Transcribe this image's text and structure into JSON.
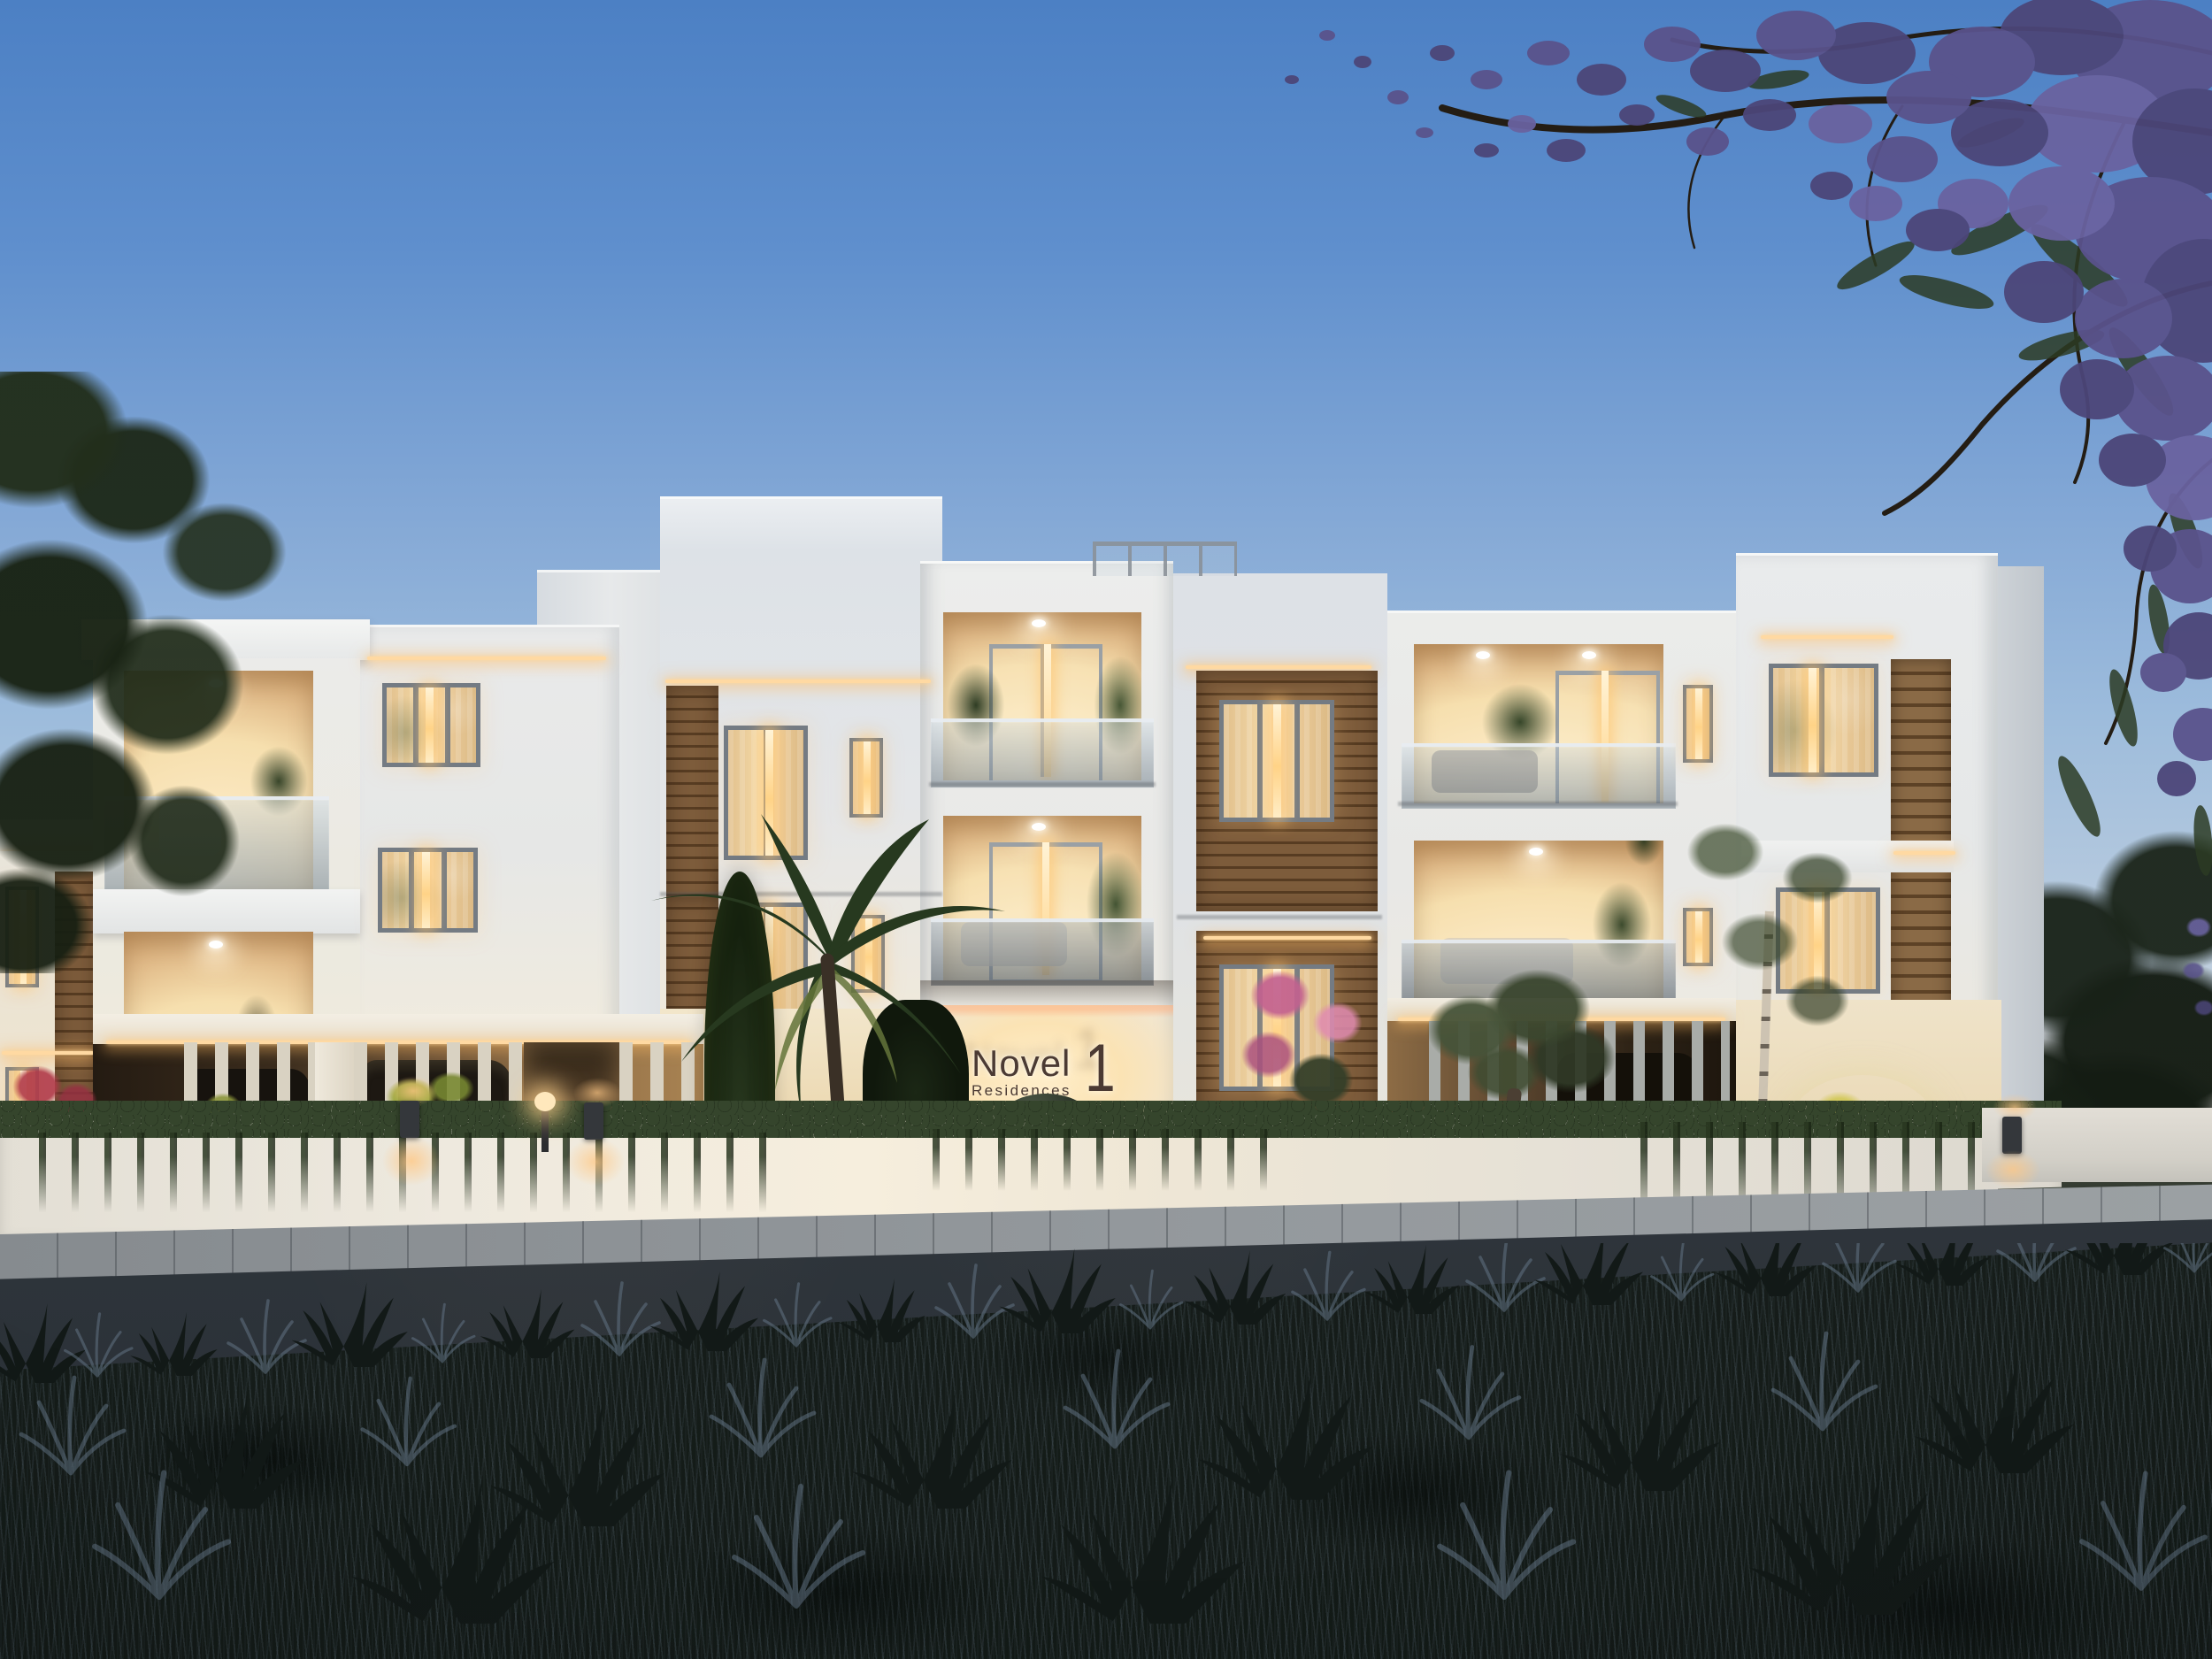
{
  "sign": {
    "brand": "Novel",
    "subtitle": "Residences",
    "number": "1"
  },
  "colors": {
    "sky_top": "#4c80c4",
    "sky_mid": "#85a9d6",
    "sky_low": "#b7cade",
    "sky_horizon": "#dcd9d4",
    "wall_shade": "#dde2e7",
    "wall_mid": "#e9e9e7",
    "wall_light": "#f3f0e9",
    "wall_warm": "#f6ecd9",
    "side_shade": "#c6ccd2",
    "interior_hi": "#fff2d6",
    "interior_mid": "#f6dfae",
    "interior_deep": "#cfa06a",
    "frame": "#747b83",
    "glass_lo": "#76848f",
    "wood_hi": "#7d5c3b",
    "wood_lo": "#573c22",
    "led": "#ffd9a2",
    "glow_warm": "#ffc785",
    "ivy": "#35452c",
    "ivy_dark": "#222e1c",
    "lit_leaf": "#9aa43f",
    "green_dark": "#24301e",
    "olive": "#465339",
    "pink": "#c2618f",
    "pink_hi": "#e08bb0",
    "red_bgv": "#b03a49",
    "purple_1": "#4c4679",
    "purple_2": "#5a538c",
    "purple_3": "#6a63a0",
    "branch": "#241d14",
    "walk": "#94999d",
    "road": "#363d44",
    "grass_base": "#1a211e",
    "grass_hi": "#6e8093",
    "sign_text": "#4b3a33",
    "car_red": "#8a2426",
    "tail_red": "#ff5f4d",
    "wall_face": "#e7e2d8",
    "field": "#343b31"
  }
}
